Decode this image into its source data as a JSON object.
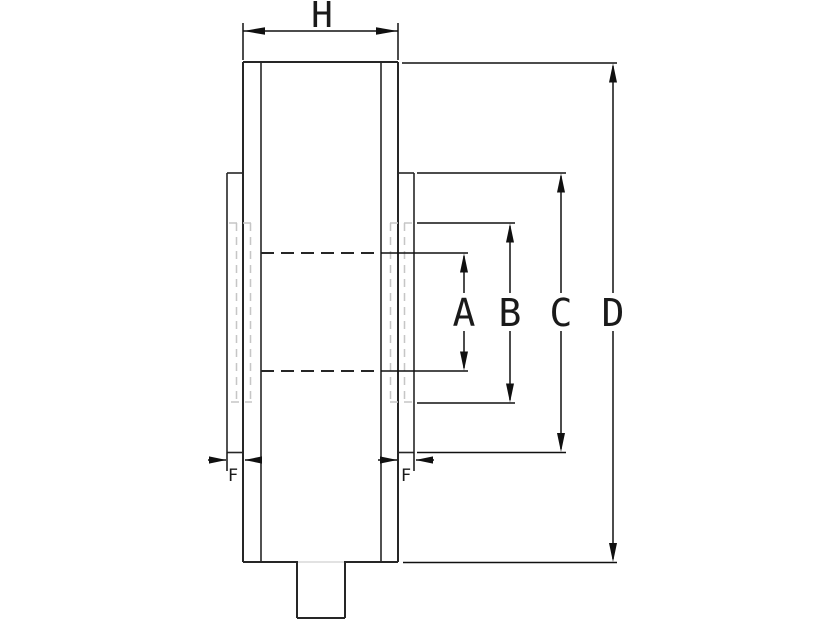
{
  "drawing": {
    "background_color": "#ffffff",
    "object_line_color": "#262626",
    "dimension_line_color": "#101010",
    "hidden_line_color": "#c6c6c6"
  },
  "labels": {
    "h": "H",
    "a": "A",
    "b": "B",
    "c": "C",
    "d": "D",
    "f_left": "F",
    "f_right": "F"
  }
}
